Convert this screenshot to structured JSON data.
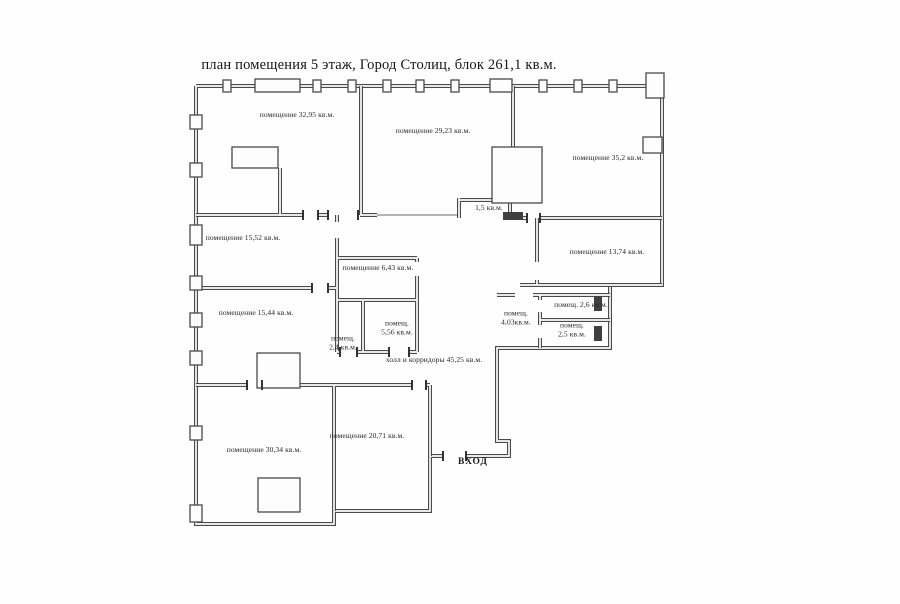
{
  "title": "план помещения 5 этаж, Город Столиц, блок 261,1 кв.м.",
  "entrance": {
    "label": "ВХОД"
  },
  "rooms": [
    {
      "lines": [
        "помещение 32,95 кв.м."
      ],
      "x": 297,
      "y": 115
    },
    {
      "lines": [
        "помещение 29,23 кв.м."
      ],
      "x": 433,
      "y": 131
    },
    {
      "lines": [
        "помещение 35,2 кв.м."
      ],
      "x": 608,
      "y": 158
    },
    {
      "lines": [
        "1,5 кв.м."
      ],
      "x": 489,
      "y": 208
    },
    {
      "lines": [
        "помещение 15,52 кв.м."
      ],
      "x": 243,
      "y": 238
    },
    {
      "lines": [
        "помещение 13,74 кв.м."
      ],
      "x": 607,
      "y": 252
    },
    {
      "lines": [
        "помещение 6,43 кв.м."
      ],
      "x": 378,
      "y": 268
    },
    {
      "lines": [
        "помещение 15,44 кв.м."
      ],
      "x": 256,
      "y": 313
    },
    {
      "lines": [
        "помещ. 2,6 кв.м."
      ],
      "x": 581,
      "y": 305
    },
    {
      "lines": [
        "помещ.",
        "4,03кв.м."
      ],
      "x": 516,
      "y": 318
    },
    {
      "lines": [
        "помещ.",
        "2,5 кв.м."
      ],
      "x": 572,
      "y": 330
    },
    {
      "lines": [
        "помещ.",
        "5,56 кв.м."
      ],
      "x": 397,
      "y": 328
    },
    {
      "lines": [
        "помещ.",
        "2,4 кв.м."
      ],
      "x": 343,
      "y": 343
    },
    {
      "lines": [
        "холл и корридоры 45,25 кв.м."
      ],
      "x": 434,
      "y": 360
    },
    {
      "lines": [
        "помещение 20,71 кв.м."
      ],
      "x": 367,
      "y": 436
    },
    {
      "lines": [
        "помещение 30,34 кв.м."
      ],
      "x": 264,
      "y": 450
    }
  ]
}
